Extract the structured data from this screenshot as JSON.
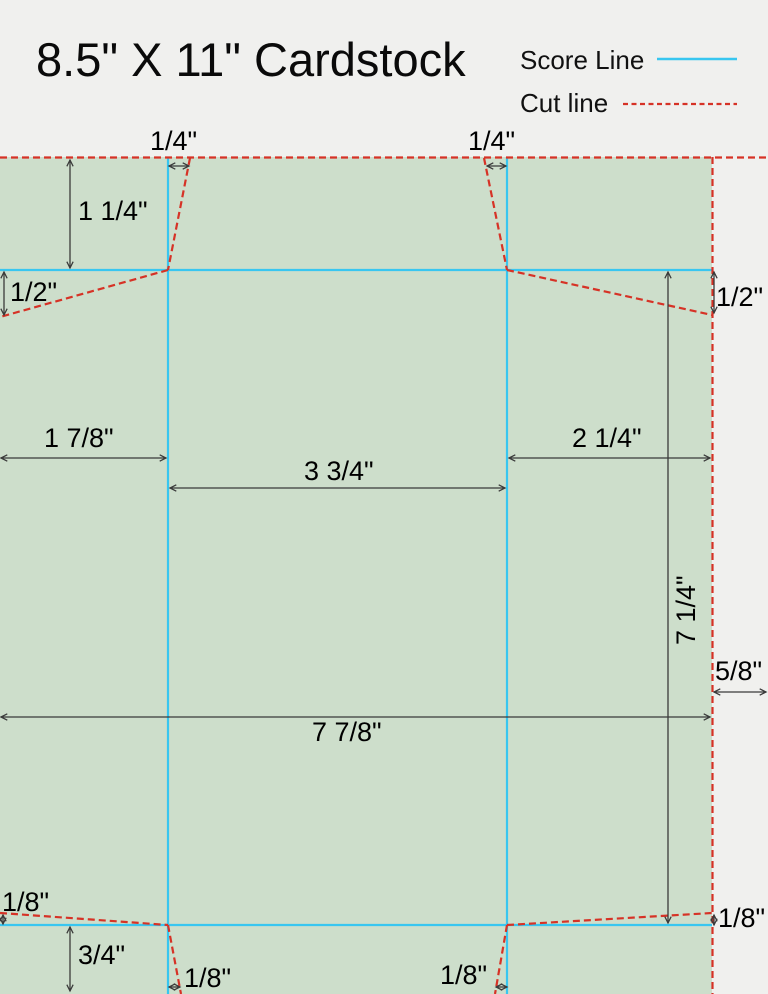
{
  "title": "8.5\" X 11\" Cardstock",
  "legend": {
    "score": {
      "label": "Score Line",
      "color": "#38c6f0",
      "style": "solid"
    },
    "cut": {
      "label": "Cut line",
      "color": "#d63226",
      "style": "dashed"
    }
  },
  "sheet": {
    "fill_color": "#cddecb",
    "background_color": "#f0f0ee",
    "dimension_line_color": "#3a3a3a"
  },
  "dimensions": {
    "top_tab_left_quarter": "1/4\"",
    "top_tab_right_quarter": "1/4\"",
    "top_flap_depth": "1 1/4\"",
    "left_flap_drop": "1/2\"",
    "right_flap_drop": "1/2\"",
    "left_panel_width": "1 7/8\"",
    "right_panel_width": "2 1/4\"",
    "center_panel_width": "3 3/4\"",
    "body_height": "7 1/4\"",
    "right_margin": "5/8\"",
    "body_width": "7 7/8\"",
    "bottom_left_edge_rise": "1/8\"",
    "bottom_flap_depth": "3/4\"",
    "bottom_tab_left_offset": "1/8\"",
    "bottom_tab_right_offset": "1/8\"",
    "bottom_right_edge_rise": "1/8\""
  }
}
